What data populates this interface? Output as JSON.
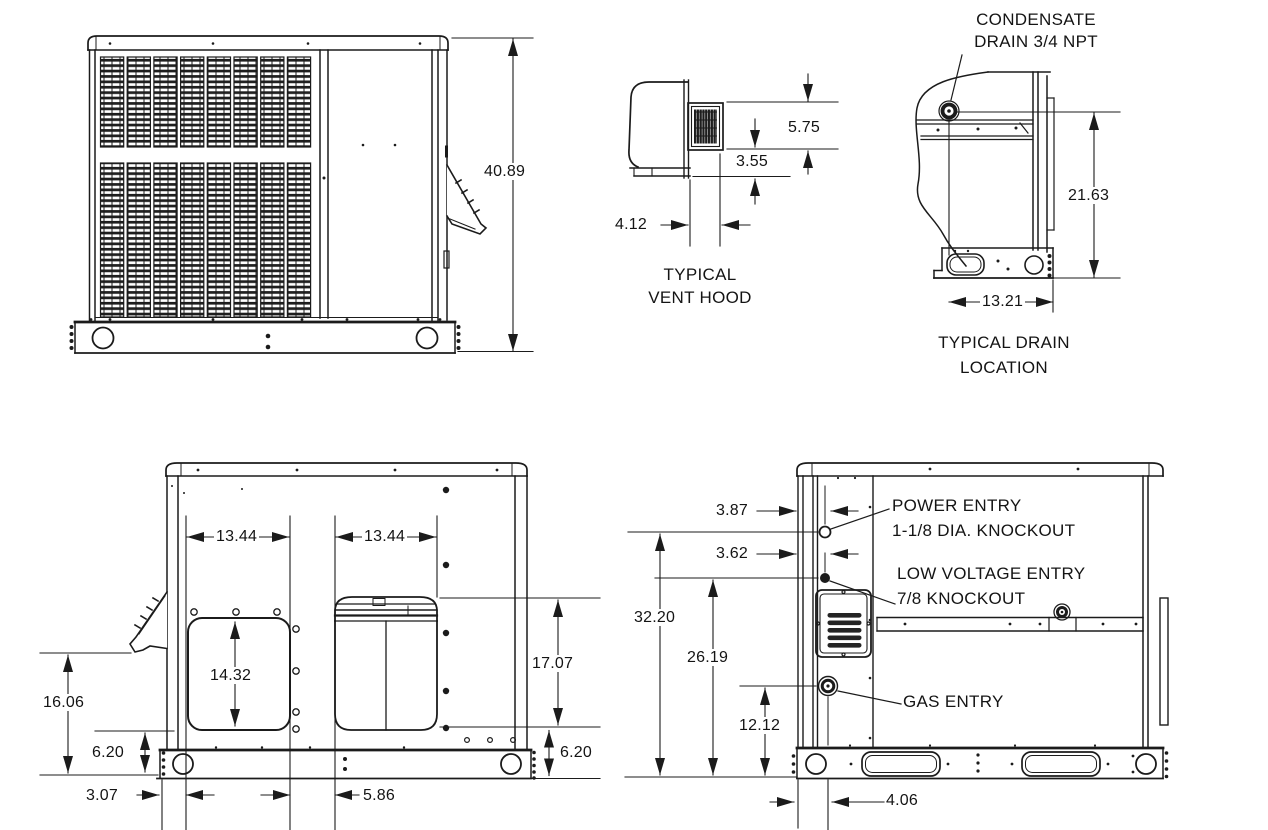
{
  "drawing": {
    "v1": {
      "height": "40.89"
    },
    "v2": {
      "dim_top": "5.75",
      "dim_mid": "3.55",
      "dim_depth": "4.12",
      "label1": "TYPICAL",
      "label2": "VENT HOOD"
    },
    "v3": {
      "callout1": "CONDENSATE",
      "callout2": "DRAIN 3/4 NPT",
      "height": "21.63",
      "width": "13.21",
      "label1": "TYPICAL DRAIN",
      "label2": "LOCATION"
    },
    "v4": {
      "supply_w": "13.44",
      "return_w": "13.44",
      "supply_h": "14.32",
      "right_h": "17.07",
      "left_h": "16.06",
      "base_l": "6.20",
      "base_r": "6.20",
      "offset": "3.07",
      "gap": "5.86"
    },
    "v5": {
      "power_off": "3.87",
      "lv_off": "3.62",
      "h1": "32.20",
      "h2": "26.19",
      "h3": "12.12",
      "gas_off": "4.06",
      "power1": "POWER ENTRY",
      "power2": "1-1/8 DIA. KNOCKOUT",
      "lv1": "LOW VOLTAGE ENTRY",
      "lv2": "7/8 KNOCKOUT",
      "gas": "GAS ENTRY"
    },
    "line_color": "#1b1b1b"
  }
}
